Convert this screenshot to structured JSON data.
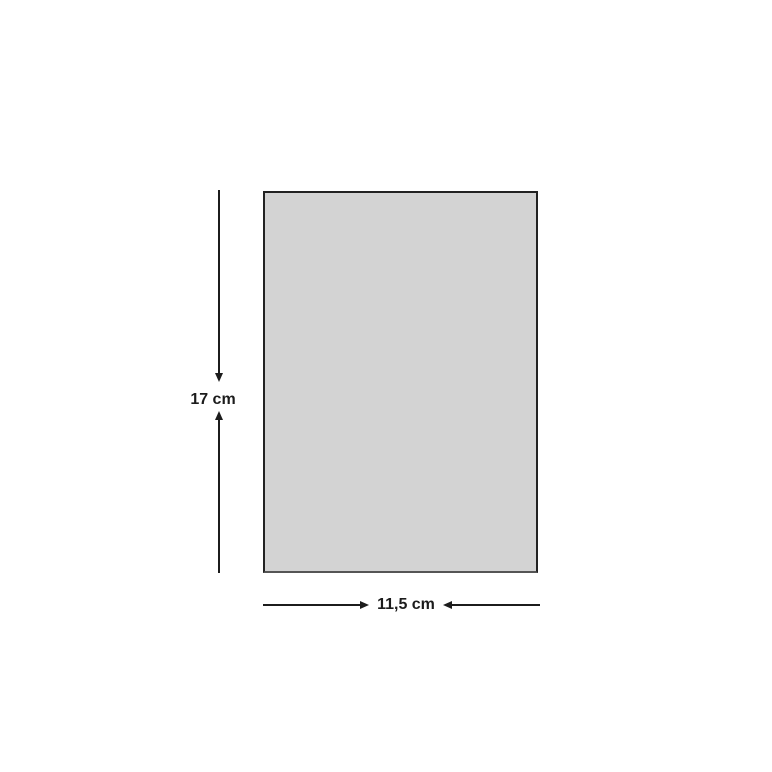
{
  "diagram": {
    "shape": "rectangle",
    "height_label": "17 cm",
    "width_label": "11,5 cm",
    "colors": {
      "background": "#ffffff",
      "rectangle_fill": "#d3d3d3",
      "rectangle_border": "#222222",
      "line_and_text": "#1c1c1c"
    }
  }
}
